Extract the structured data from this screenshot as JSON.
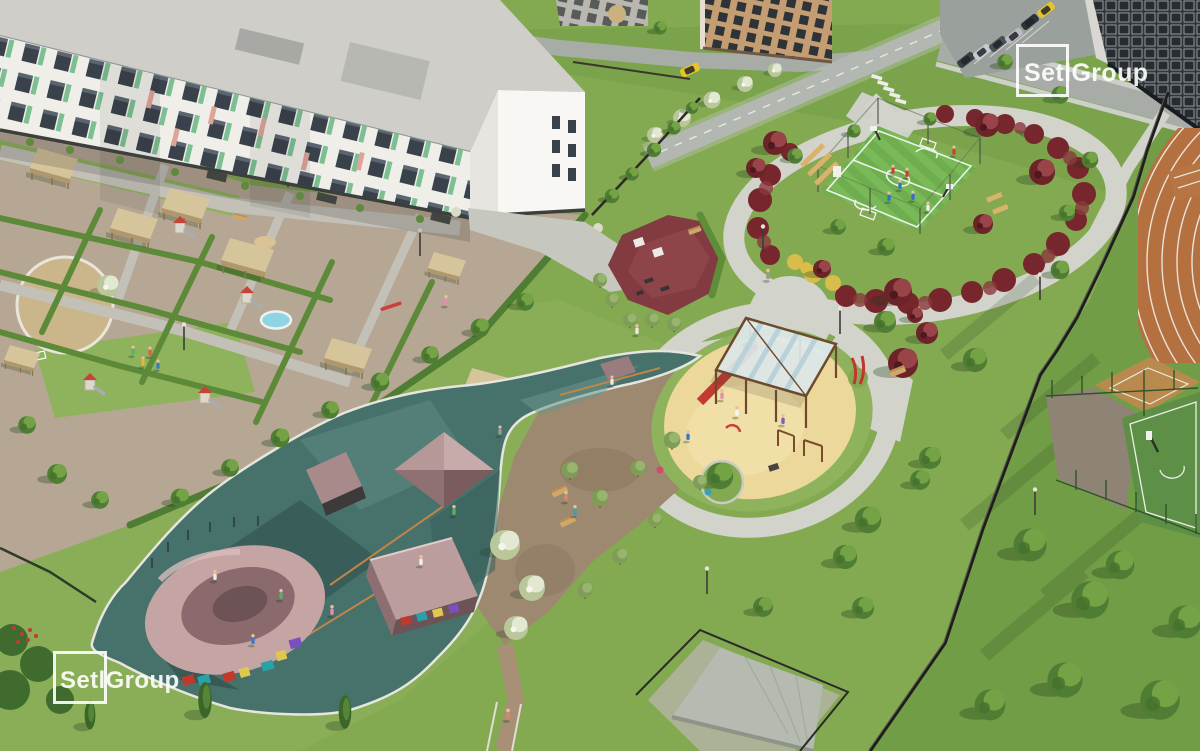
{
  "watermarks": {
    "top_right": {
      "text": "SetlGroup"
    },
    "bottom_left": {
      "text": "SetlGroup"
    }
  },
  "palette": {
    "grass": "#83a951",
    "grassDark": "#729d47",
    "grassTop": "#7aa34c",
    "grassLight": "#8fb35c",
    "path": "#d2d3cb",
    "road": "#a7aca7",
    "sidewalk": "#cdd0c8",
    "parking": "#9aa09b",
    "roofGray": "#cfcec9",
    "facadeWhite": "#efeee9",
    "endwallWhite": "#f8f7f3",
    "windowDark": "#39414a",
    "accentGreen": "#67b784",
    "accentSalmon": "#dfa398",
    "brick": "#c49d73",
    "highrise": "#31373d",
    "courtGreen": "#6fae4e",
    "marking": "#f3f6f0",
    "shrubBurgundy": "#76262c",
    "shrubYellow": "#d8bd4a",
    "redTree": "#6d2428",
    "sandYellow": "#ecd89b",
    "rubberMaroon": "#823c41",
    "skateTeal": "#47726c",
    "rampMauve": "#bb9d9d",
    "rampDark": "#6d5356",
    "dirt": "#9d8870",
    "woodTan": "#d6c49a",
    "fenceDark": "#1d1d1b",
    "treeGreen": "#4f7d33",
    "treeLight": "#74a345",
    "paleTree": "#ccd6b0",
    "taxiYellow": "#e8c428",
    "logoWhite": "rgba(255,255,255,0.9)"
  }
}
